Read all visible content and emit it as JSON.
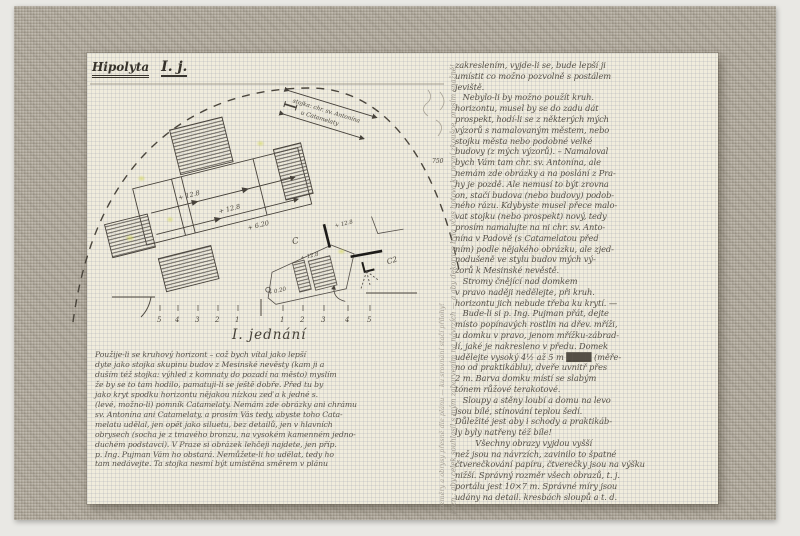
{
  "page": {
    "title_main": "Hipolyta",
    "title_part": "I. j.",
    "heading": "I. jednání"
  },
  "sketch": {
    "diagonal_label_line1": "stojka: chr. sv. Antonína",
    "diagonal_label_line2": "u Catamelaty",
    "dim1": "+ 12.8",
    "dim2": "+ 12.8",
    "dim3": "+ 6.20",
    "small_dim_top": "+ 12.8",
    "small_dim_mid": "+ 12.8",
    "small_dim_low": "+ 0.20",
    "label_c": "C",
    "label_c2": "C2",
    "faint_number": "750",
    "ruler_numbers": [
      "5",
      "4",
      "3",
      "2",
      "1",
      "1",
      "2",
      "3",
      "4",
      "5"
    ]
  },
  "left_column": {
    "lines": [
      "Použije-li se kruhový horizont – což bych vítal jako lepší",
      "dyte jako stojka skupinu budov z Mesinské nevěsty (kam ji a",
      "duším též stojka: výhled z komnaty do pozadí na město) myslím",
      "že by se to tam hodilo, pamatuji-li se ještě dobře. Před tu by",
      "jako kryt spodku horizontu nějakou nízkou zeď a k jedné s.",
      "(levé, možno-li) pomník Catamelaty. Nemám zde obrázky ani chrámu",
      "sv. Antonína ani Catamelaty, a prosím Vás tedy, abyste toho Cata-",
      "melatu udělal, jen opět jako siluetu, bez detailů, jen v hlavních",
      "obrysech (socha je z tmavého bronzu, na vysokém kamenném jedno-",
      "duchém podstavci). V Praze si obrázek lehčeji najdete, jen příp.",
      "p. Ing. Pujman Vám ho obstará. Nemůžete-li ho udělat, tedy ho",
      "tam nedávejte. Ta stojka nesmí být umístěna směrem v plánu"
    ]
  },
  "right_column": {
    "lines": [
      "zakreslením, vyjde-li se, bude lepší ji",
      "umístit co možno pozvolně s postálem",
      "jeviště.",
      "   Nebylo-li by možno použít kruh.",
      "horizontu, musel by se do zadu dát",
      "prospekt, hodí-li se z některých mých",
      "výzorů s namalovaným městem, nebo",
      "stojku města nebo podobné velké",
      "budovy (z mých výzorů). – Namaloval",
      "bych Vám tam chr. sv. Antonína, ale",
      "nemám zde obrázky a na poslání z Pra-",
      "hy je pozdě. Ale nemusí to být zrovna",
      "on, stačí budova (nebo budovy) podob-",
      "ného rázu. Kdybyste musel přece malo-",
      "vat stojku (nebo prospekt) nový, tedy",
      "prosím namalujte na ni chr. sv. Anto-",
      "nína v Padově (s Catamelatou před",
      "ním) podle nějakého obrázku, ale zjed-",
      "nodušeně ve stylu budov mých vý-",
      "zorů k Mesinské nevěstě.",
      "   Stromy čnějící nad domkem",
      "v pravo naději nedělejte, při kruh.",
      "horizontu jich nebude třeba ku krytí. —",
      "   Bude-li si p. Ing. Pujman přát, dejte",
      "místo popínavých rostlin na dřev. mříži,",
      "u domku v pravo, jenom mřížku-zábrad-",
      "lí, jaké je nakresleno v předu. Domek",
      "udělejte vysoký 4½ až 5 m ████ (měře-",
      "no od praktikáblu), dveře uvnitř přes",
      "2 m. Barva domku místí se slabým",
      "tónem růžové terakotové.",
      "   Sloupy a stěny loubí a domu na levo",
      "jsou bílé, stínování teplou šedí.",
      "Důležité jest aby i schody a praktikáb-",
      "ly byly natřeny též bíle!",
      "        Všechny obrazy vyjdou vyšší",
      "než jsou na návrzích, zavinilo to špatné",
      "čtverečkování papíru, čtverečky jsou na výšku",
      "nižší. Správný rozměr všech obrazů, t. j.",
      "portálu jest 10×7 m. Správné míry jsou",
      "udány na detail. kresbách sloupů a t. d."
    ]
  },
  "margin_notes": {
    "vertical_a": "pozn.: aby celek souhlasil s mým zabarvením na návrzích — a aby dekorace byla včas hotova ku první zkoušce, prosím snažně!",
    "vertical_b": "rozměry a obrysy přesně dle plánu — ku srovnání stačí přílohy!"
  },
  "colors": {
    "mat_linen": "#b1aa9d",
    "paper": "#f0ecdc",
    "ink": "#3a362f",
    "pencil": "#554f46",
    "faint_pencil": "#a49e93",
    "highlight": "#d4d85a"
  }
}
